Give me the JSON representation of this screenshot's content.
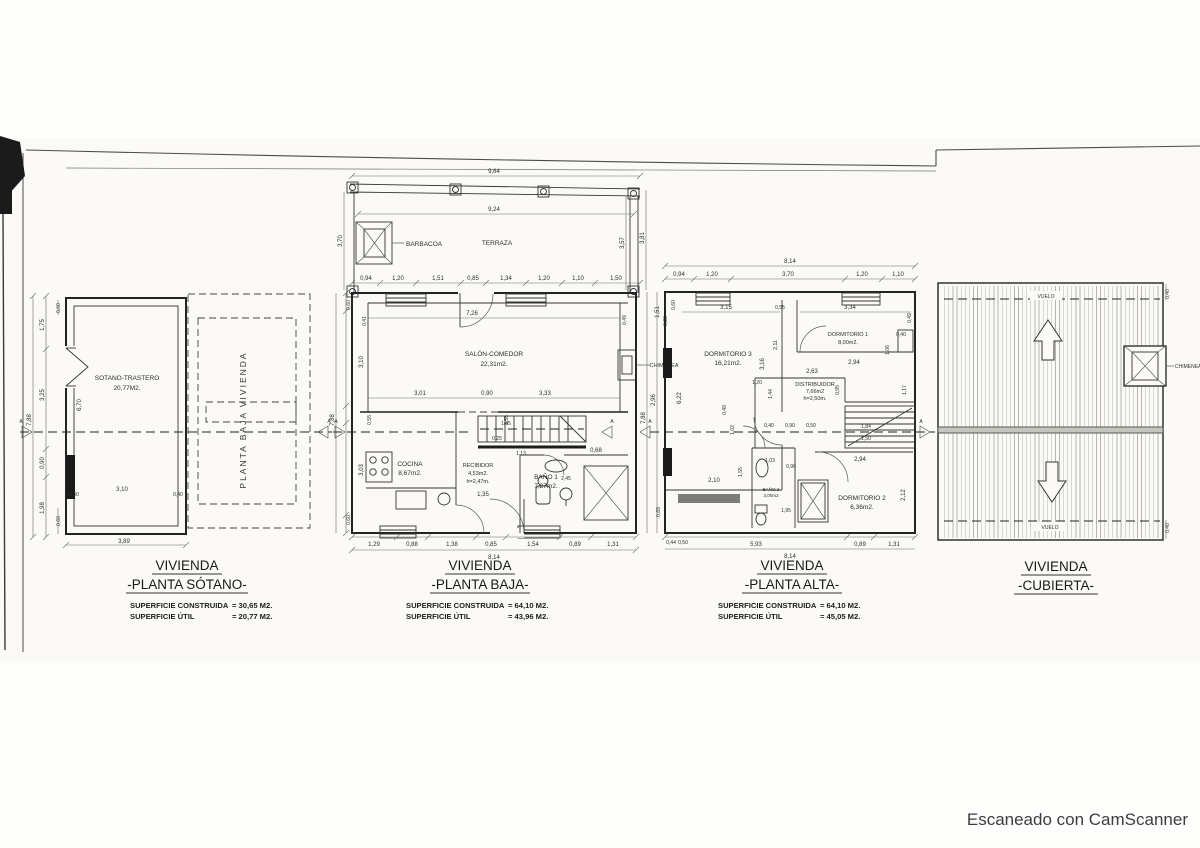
{
  "footer": "Escaneado con CamScanner",
  "section_letter": "A",
  "plans": {
    "sotano": {
      "title1": "VIVIENDA",
      "title2": "-PLANTA SÓTANO-",
      "sup": [
        {
          "label": "SUPERFICIE CONSTRUIDA",
          "value": "= 30,65 M2."
        },
        {
          "label": "SUPERFICIE ÚTIL",
          "value": "= 20,77 M2."
        }
      ],
      "room_name": "SOTANO-TRASTERO",
      "room_area": "20,77M2.",
      "overlay_label": "PLANTA BAJA VIVIENDA",
      "dims": [
        "7,88",
        "1,75",
        "3,25",
        "0,90",
        "1,98",
        "0,60",
        "6,70",
        "3,10",
        "0,30",
        "0,40",
        "0,60",
        "3,89"
      ]
    },
    "baja": {
      "title1": "VIVIENDA",
      "title2": "-PLANTA BAJA-",
      "sup": [
        {
          "label": "SUPERFICIE CONSTRUIDA",
          "value": "= 64,10 M2."
        },
        {
          "label": "SUPERFICIE ÚTIL",
          "value": "= 43,96 M2."
        }
      ],
      "rooms": {
        "terraza": "TERRAZA",
        "barbacoa": "BARBACOA",
        "salon": [
          "SALÓN-COMEDOR",
          "22,31m2."
        ],
        "cocina": [
          "COCINA",
          "8,67m2."
        ],
        "recibidor": [
          "RECIBIDOR",
          "4,53m2.",
          "h=2,47m."
        ],
        "bano1": [
          "BAÑO 1",
          "7,27m2."
        ],
        "chimenea": "CHIMENEA"
      },
      "dims": [
        "9,64",
        "9,24",
        "3,70",
        "3,57",
        "3,81",
        "0,94",
        "1,20",
        "1,51",
        "0,85",
        "1,34",
        "1,20",
        "1,10",
        "1,50",
        "0,60",
        "0,41",
        "7,26",
        "0,49",
        "3,10",
        "3,01",
        "0,90",
        "3,33",
        "0,55",
        "0,55",
        "1,45",
        "0,25",
        "1,13",
        "0,68",
        "3,03",
        "1,35",
        "2,45",
        "1,29",
        "0,88",
        "1,38",
        "0,85",
        "1,54",
        "0,89",
        "1,31",
        "8,14",
        "7,88",
        "0,60"
      ]
    },
    "alta": {
      "title1": "VIVIENDA",
      "title2": "-PLANTA ALTA-",
      "sup": [
        {
          "label": "SUPERFICIE CONSTRUIDA",
          "value": "= 64,10 M2."
        },
        {
          "label": "SUPERFICIE ÚTIL",
          "value": "= 45,05 M2."
        }
      ],
      "rooms": {
        "dorm3": [
          "DORMITORIO 3",
          "16,21m2."
        ],
        "dorm1": [
          "DORMITORIO 1",
          "8,00m2."
        ],
        "distribuidor": [
          "DISTRIBUIDOR",
          "7,66m2",
          "h=2,50m."
        ],
        "bano2": [
          "BAÑO 2",
          "3,00m2"
        ],
        "dorm2": [
          "DORMITORIO 2",
          "6,36m2."
        ]
      },
      "dims": [
        "8,14",
        "0,94",
        "1,20",
        "3,70",
        "1,20",
        "1,10",
        "1,51",
        "0,60",
        "0,30",
        "3,15",
        "0,55",
        "3,34",
        "0,49",
        "2,11",
        "3,16",
        "0,40",
        "1,06",
        "2,94",
        "2,63",
        "0,95",
        "1,44",
        "1,17",
        "1,20",
        "0,49",
        "1,02",
        "0,40",
        "0,90",
        "0,50",
        "1,84",
        "1,50",
        "6,22",
        "7,88",
        "2,96",
        "1,55",
        "2,10",
        "1,03",
        "0,90",
        "1,95",
        "2,94",
        "2,12",
        "5,93",
        "0,89",
        "1,31",
        "8,14",
        "0,89",
        "0,44",
        "0,50"
      ]
    },
    "cubierta": {
      "title1": "VIVIENDA",
      "title2": "-CUBIERTA-",
      "vuelo_top": "VUELO",
      "vuelo_bottom": "VUELO",
      "chimenea": "CHIMENEA",
      "dims": [
        "0,40",
        "0,40"
      ]
    }
  }
}
